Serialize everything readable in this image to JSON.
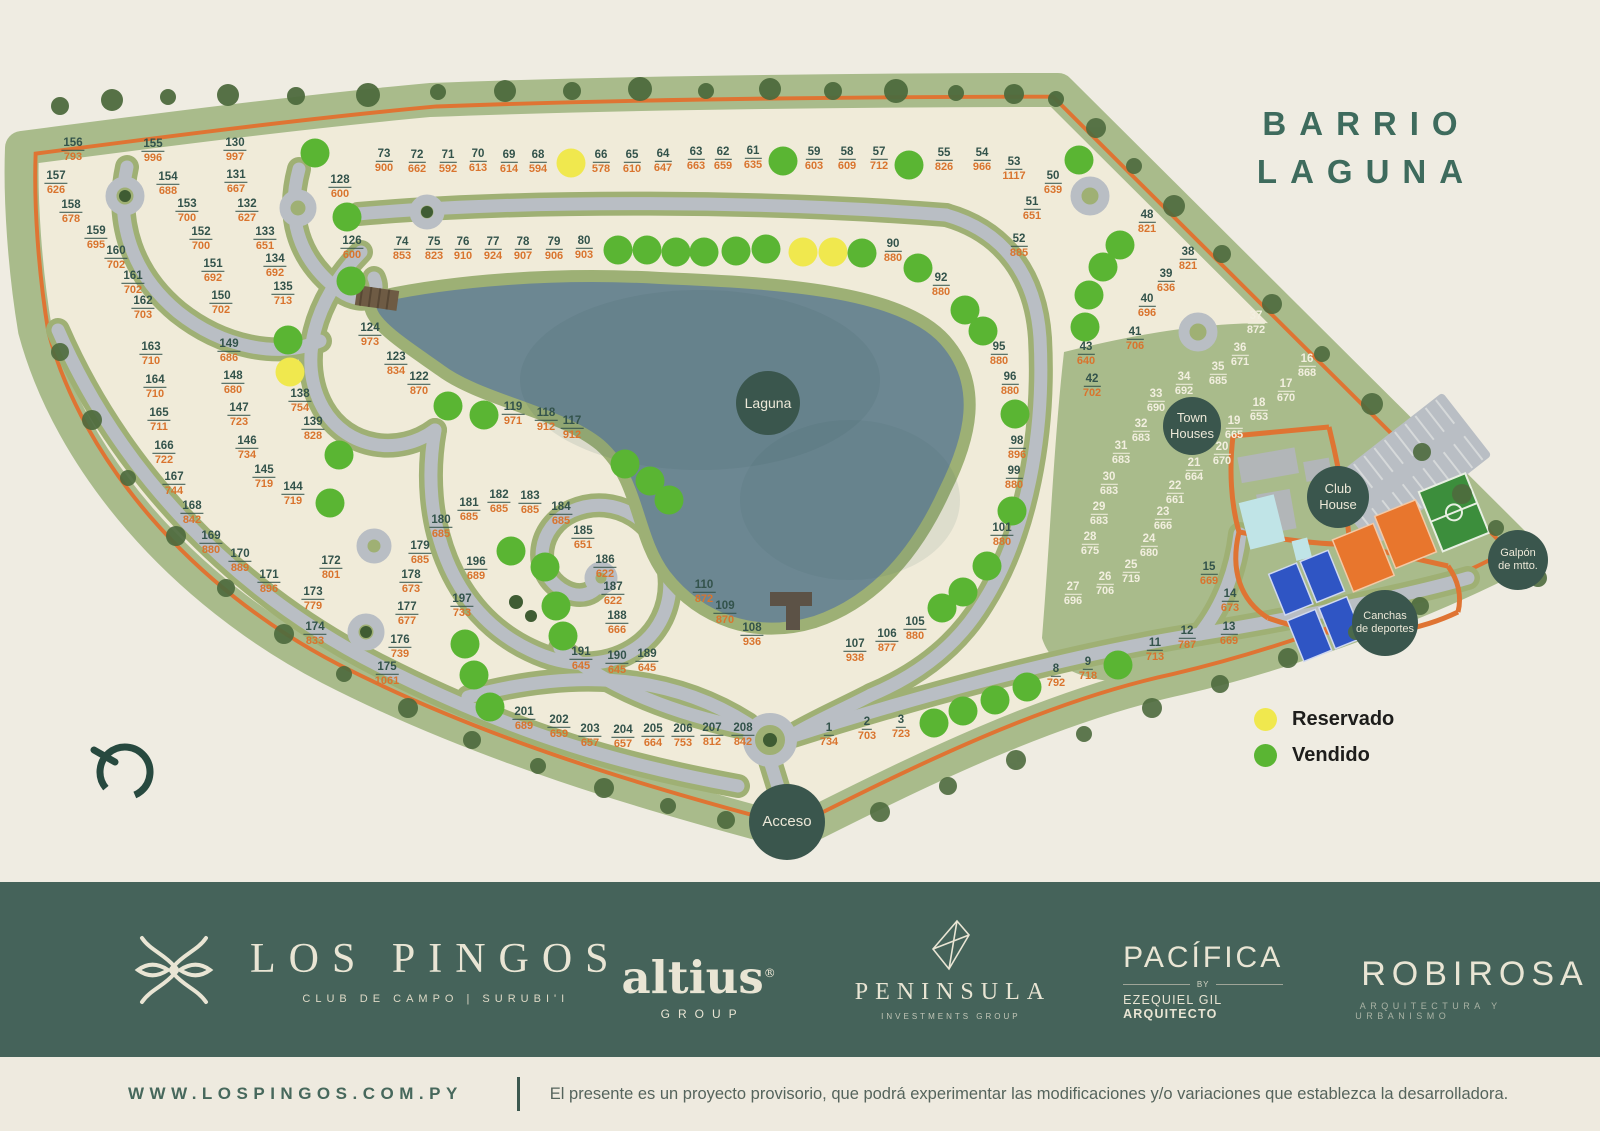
{
  "title": {
    "line1": "BARRIO",
    "line2": "LAGUNA"
  },
  "legend": {
    "reserved_label": "Reservado",
    "sold_label": "Vendido"
  },
  "colors": {
    "background": "#efece2",
    "grass": "#a9bb8b",
    "lot_fill": "#f0ebd9",
    "road": "#b9bec4",
    "perimeter_line": "#df7433",
    "lagoon": "#6c8792",
    "poi_circle": "#3a564d",
    "lot_number": "#33534b",
    "lot_price": "#d9742e",
    "sold": "#5ab533",
    "reserved": "#f0e84e",
    "footer": "#45635a",
    "title_green": "#3e6b5d"
  },
  "map": {
    "poi": [
      {
        "id": "laguna",
        "lines": [
          "Laguna"
        ],
        "x": 768,
        "y": 403,
        "d": 64,
        "fs": 14
      },
      {
        "id": "town-houses",
        "lines": [
          "Town",
          "Houses"
        ],
        "x": 1192,
        "y": 426,
        "d": 58,
        "fs": 13
      },
      {
        "id": "club-house",
        "lines": [
          "Club",
          "House"
        ],
        "x": 1338,
        "y": 497,
        "d": 62,
        "fs": 13
      },
      {
        "id": "canchas",
        "lines": [
          "Canchas",
          "de deportes"
        ],
        "x": 1385,
        "y": 623,
        "d": 66,
        "fs": 11
      },
      {
        "id": "galpon",
        "lines": [
          "Galpón",
          "de mtto."
        ],
        "x": 1518,
        "y": 560,
        "d": 60,
        "fs": 11
      },
      {
        "id": "acceso",
        "lines": [
          "Acceso"
        ],
        "x": 787,
        "y": 822,
        "d": 76,
        "fs": 15
      }
    ],
    "lots": [
      [
        "156",
        "793",
        73,
        149,
        0
      ],
      [
        "155",
        "996",
        153,
        150,
        0
      ],
      [
        "130",
        "997",
        235,
        149,
        0
      ],
      [
        "157",
        "626",
        56,
        182,
        0
      ],
      [
        "154",
        "688",
        168,
        183,
        0
      ],
      [
        "131",
        "667",
        236,
        181,
        0
      ],
      [
        "128",
        "600",
        340,
        186,
        0
      ],
      [
        "158",
        "678",
        71,
        211,
        0
      ],
      [
        "153",
        "700",
        187,
        210,
        0
      ],
      [
        "132",
        "627",
        247,
        210,
        0
      ],
      [
        "159",
        "695",
        96,
        237,
        0
      ],
      [
        "152",
        "700",
        201,
        238,
        0
      ],
      [
        "133",
        "651",
        265,
        238,
        0
      ],
      [
        "126",
        "600",
        352,
        247,
        0
      ],
      [
        "160",
        "702",
        116,
        257,
        0
      ],
      [
        "151",
        "692",
        213,
        270,
        0
      ],
      [
        "134",
        "692",
        275,
        265,
        0
      ],
      [
        "161",
        "702",
        133,
        282,
        0
      ],
      [
        "150",
        "702",
        221,
        302,
        0
      ],
      [
        "135",
        "713",
        283,
        293,
        0
      ],
      [
        "162",
        "703",
        143,
        307,
        0
      ],
      [
        "73",
        "900",
        384,
        160,
        0
      ],
      [
        "72",
        "662",
        417,
        161,
        0
      ],
      [
        "71",
        "592",
        448,
        161,
        0
      ],
      [
        "70",
        "613",
        478,
        160,
        0
      ],
      [
        "69",
        "614",
        509,
        161,
        0
      ],
      [
        "68",
        "594",
        538,
        161,
        0
      ],
      [
        "66",
        "578",
        601,
        161,
        0
      ],
      [
        "65",
        "610",
        632,
        161,
        0
      ],
      [
        "64",
        "647",
        663,
        160,
        0
      ],
      [
        "63",
        "663",
        696,
        158,
        0
      ],
      [
        "62",
        "659",
        723,
        158,
        0
      ],
      [
        "61",
        "635",
        753,
        157,
        0
      ],
      [
        "59",
        "603",
        814,
        158,
        0
      ],
      [
        "58",
        "609",
        847,
        158,
        0
      ],
      [
        "57",
        "712",
        879,
        158,
        0
      ],
      [
        "55",
        "826",
        944,
        159,
        0
      ],
      [
        "54",
        "966",
        982,
        159,
        0
      ],
      [
        "53",
        "1117",
        1014,
        168,
        0
      ],
      [
        "74",
        "853",
        402,
        248,
        0
      ],
      [
        "75",
        "823",
        434,
        248,
        0
      ],
      [
        "76",
        "910",
        463,
        248,
        0
      ],
      [
        "77",
        "924",
        493,
        248,
        0
      ],
      [
        "78",
        "907",
        523,
        248,
        0
      ],
      [
        "79",
        "906",
        554,
        248,
        0
      ],
      [
        "80",
        "903",
        584,
        247,
        0
      ],
      [
        "90",
        "880",
        893,
        250,
        0
      ],
      [
        "50",
        "639",
        1053,
        182,
        0
      ],
      [
        "51",
        "651",
        1032,
        208,
        0
      ],
      [
        "52",
        "885",
        1019,
        245,
        0
      ],
      [
        "48",
        "821",
        1147,
        221,
        0
      ],
      [
        "38",
        "821",
        1188,
        258,
        0
      ],
      [
        "39",
        "636",
        1166,
        280,
        0
      ],
      [
        "40",
        "696",
        1147,
        305,
        0
      ],
      [
        "41",
        "706",
        1135,
        338,
        0
      ],
      [
        "43",
        "640",
        1086,
        353,
        0
      ],
      [
        "42",
        "702",
        1092,
        385,
        0
      ],
      [
        "92",
        "880",
        941,
        284,
        0
      ],
      [
        "95",
        "880",
        999,
        353,
        0
      ],
      [
        "96",
        "880",
        1010,
        383,
        0
      ],
      [
        "98",
        "896",
        1017,
        447,
        0
      ],
      [
        "99",
        "880",
        1014,
        477,
        0
      ],
      [
        "101",
        "880",
        1002,
        534,
        0
      ],
      [
        "37",
        "872",
        1256,
        322,
        1
      ],
      [
        "36",
        "671",
        1240,
        354,
        1
      ],
      [
        "35",
        "685",
        1218,
        373,
        1
      ],
      [
        "34",
        "692",
        1184,
        383,
        1
      ],
      [
        "33",
        "690",
        1156,
        400,
        1
      ],
      [
        "32",
        "683",
        1141,
        430,
        1
      ],
      [
        "31",
        "683",
        1121,
        452,
        1
      ],
      [
        "30",
        "683",
        1109,
        483,
        1
      ],
      [
        "29",
        "683",
        1099,
        513,
        1
      ],
      [
        "28",
        "675",
        1090,
        543,
        1
      ],
      [
        "27",
        "696",
        1073,
        593,
        1
      ],
      [
        "26",
        "706",
        1105,
        583,
        1
      ],
      [
        "25",
        "719",
        1131,
        571,
        1
      ],
      [
        "24",
        "680",
        1149,
        545,
        1
      ],
      [
        "23",
        "666",
        1163,
        518,
        1
      ],
      [
        "22",
        "661",
        1175,
        492,
        1
      ],
      [
        "21",
        "664",
        1194,
        469,
        1
      ],
      [
        "20",
        "670",
        1222,
        453,
        1
      ],
      [
        "19",
        "665",
        1234,
        427,
        1
      ],
      [
        "18",
        "653",
        1259,
        409,
        1
      ],
      [
        "17",
        "670",
        1286,
        390,
        1
      ],
      [
        "16",
        "868",
        1307,
        365,
        1
      ],
      [
        "163",
        "710",
        151,
        353,
        0
      ],
      [
        "164",
        "710",
        155,
        386,
        0
      ],
      [
        "165",
        "711",
        159,
        419,
        0
      ],
      [
        "166",
        "722",
        164,
        452,
        0
      ],
      [
        "167",
        "744",
        174,
        483,
        0
      ],
      [
        "168",
        "842",
        192,
        512,
        0
      ],
      [
        "149",
        "686",
        229,
        350,
        0
      ],
      [
        "148",
        "680",
        233,
        382,
        0
      ],
      [
        "147",
        "723",
        239,
        414,
        0
      ],
      [
        "146",
        "734",
        247,
        447,
        0
      ],
      [
        "145",
        "719",
        264,
        476,
        0
      ],
      [
        "144",
        "719",
        293,
        493,
        0
      ],
      [
        "138",
        "754",
        300,
        400,
        0
      ],
      [
        "139",
        "828",
        313,
        428,
        0
      ],
      [
        "124",
        "973",
        370,
        334,
        0
      ],
      [
        "123",
        "834",
        396,
        363,
        0
      ],
      [
        "122",
        "870",
        419,
        383,
        0
      ],
      [
        "119",
        "971",
        513,
        413,
        0
      ],
      [
        "118",
        "912",
        546,
        419,
        0
      ],
      [
        "117",
        "912",
        572,
        427,
        0
      ],
      [
        "179",
        "685",
        420,
        552,
        0
      ],
      [
        "180",
        "685",
        441,
        526,
        0
      ],
      [
        "181",
        "685",
        469,
        509,
        0
      ],
      [
        "182",
        "685",
        499,
        501,
        0
      ],
      [
        "183",
        "685",
        530,
        502,
        0
      ],
      [
        "184",
        "685",
        561,
        513,
        0
      ],
      [
        "185",
        "651",
        583,
        537,
        0
      ],
      [
        "186",
        "622",
        605,
        566,
        0
      ],
      [
        "187",
        "622",
        613,
        593,
        0
      ],
      [
        "188",
        "666",
        617,
        622,
        0
      ],
      [
        "189",
        "645",
        647,
        660,
        0
      ],
      [
        "190",
        "645",
        617,
        662,
        0
      ],
      [
        "191",
        "645",
        581,
        658,
        0
      ],
      [
        "196",
        "689",
        476,
        568,
        0
      ],
      [
        "197",
        "733",
        462,
        605,
        0
      ],
      [
        "169",
        "880",
        211,
        542,
        0
      ],
      [
        "170",
        "889",
        240,
        560,
        0
      ],
      [
        "171",
        "896",
        269,
        581,
        0
      ],
      [
        "172",
        "801",
        331,
        567,
        0
      ],
      [
        "173",
        "779",
        313,
        598,
        0
      ],
      [
        "174",
        "833",
        315,
        633,
        0
      ],
      [
        "175",
        "1061",
        387,
        673,
        0
      ],
      [
        "176",
        "739",
        400,
        646,
        0
      ],
      [
        "177",
        "677",
        407,
        613,
        0
      ],
      [
        "178",
        "673",
        411,
        581,
        0
      ],
      [
        "201",
        "689",
        524,
        718,
        0
      ],
      [
        "202",
        "659",
        559,
        726,
        0
      ],
      [
        "203",
        "657",
        590,
        735,
        0
      ],
      [
        "204",
        "657",
        623,
        736,
        0
      ],
      [
        "205",
        "664",
        653,
        735,
        0
      ],
      [
        "206",
        "753",
        683,
        735,
        0
      ],
      [
        "207",
        "812",
        712,
        734,
        0
      ],
      [
        "208",
        "842",
        743,
        734,
        0
      ],
      [
        "110",
        "872",
        704,
        591,
        0
      ],
      [
        "109",
        "870",
        725,
        612,
        0
      ],
      [
        "108",
        "936",
        752,
        634,
        0
      ],
      [
        "107",
        "938",
        855,
        650,
        0
      ],
      [
        "106",
        "877",
        887,
        640,
        0
      ],
      [
        "105",
        "880",
        915,
        628,
        0
      ],
      [
        "1",
        "734",
        829,
        734,
        0
      ],
      [
        "2",
        "703",
        867,
        728,
        0
      ],
      [
        "3",
        "723",
        901,
        726,
        0
      ],
      [
        "8",
        "792",
        1056,
        675,
        0
      ],
      [
        "9",
        "718",
        1088,
        668,
        0
      ],
      [
        "11",
        "713",
        1155,
        649,
        0
      ],
      [
        "12",
        "787",
        1187,
        637,
        0
      ],
      [
        "13",
        "669",
        1229,
        633,
        0
      ],
      [
        "14",
        "673",
        1230,
        600,
        0
      ],
      [
        "15",
        "669",
        1209,
        573,
        0
      ]
    ],
    "status_dots": [
      [
        315,
        153,
        "s"
      ],
      [
        347,
        217,
        "s"
      ],
      [
        351,
        281,
        "s"
      ],
      [
        783,
        161,
        "s"
      ],
      [
        909,
        165,
        "s"
      ],
      [
        1079,
        160,
        "s"
      ],
      [
        618,
        250,
        "s"
      ],
      [
        647,
        250,
        "s"
      ],
      [
        676,
        252,
        "s"
      ],
      [
        704,
        252,
        "s"
      ],
      [
        736,
        251,
        "s"
      ],
      [
        766,
        249,
        "s"
      ],
      [
        862,
        253,
        "s"
      ],
      [
        918,
        268,
        "s"
      ],
      [
        1120,
        245,
        "s"
      ],
      [
        1103,
        267,
        "s"
      ],
      [
        1089,
        295,
        "s"
      ],
      [
        1085,
        327,
        "s"
      ],
      [
        965,
        310,
        "s"
      ],
      [
        983,
        331,
        "s"
      ],
      [
        1015,
        414,
        "s"
      ],
      [
        1012,
        511,
        "s"
      ],
      [
        288,
        340,
        "s"
      ],
      [
        339,
        455,
        "s"
      ],
      [
        330,
        503,
        "s"
      ],
      [
        448,
        406,
        "s"
      ],
      [
        484,
        415,
        "s"
      ],
      [
        625,
        464,
        "s"
      ],
      [
        650,
        481,
        "s"
      ],
      [
        669,
        500,
        "s"
      ],
      [
        511,
        551,
        "s"
      ],
      [
        545,
        567,
        "s"
      ],
      [
        556,
        606,
        "s"
      ],
      [
        563,
        636,
        "s"
      ],
      [
        465,
        644,
        "s"
      ],
      [
        474,
        675,
        "s"
      ],
      [
        490,
        707,
        "s"
      ],
      [
        942,
        608,
        "s"
      ],
      [
        963,
        592,
        "s"
      ],
      [
        987,
        566,
        "s"
      ],
      [
        934,
        723,
        "s"
      ],
      [
        963,
        711,
        "s"
      ],
      [
        995,
        700,
        "s"
      ],
      [
        1027,
        687,
        "s"
      ],
      [
        1118,
        665,
        "s"
      ],
      [
        571,
        163,
        "r"
      ],
      [
        803,
        252,
        "r"
      ],
      [
        833,
        252,
        "r"
      ],
      [
        290,
        372,
        "r"
      ]
    ]
  },
  "footer": {
    "brand": {
      "name": "LOS PINGOS",
      "tagline": "CLUB DE CAMPO | SURUBI'I"
    },
    "altius": {
      "name": "altius",
      "reg": "®",
      "sub": "GROUP"
    },
    "peninsula": {
      "name": "PENINSULA",
      "sub": "INVESTMENTS GROUP"
    },
    "pacifica": {
      "name": "PACÍFICA",
      "by": "BY",
      "sub1": "EZEQUIEL GIL ",
      "sub2": "ARQUITECTO"
    },
    "robirosa": {
      "name": "ROBIROSA",
      "sub": "ARQUITECTURA Y URBANISMO"
    }
  },
  "bottombar": {
    "website": "WWW.LOSPINGOS.COM.PY",
    "disclaimer": "El presente es un proyecto provisorio, que podrá experimentar las modificaciones y/o variaciones que establezca la desarrolladora."
  }
}
